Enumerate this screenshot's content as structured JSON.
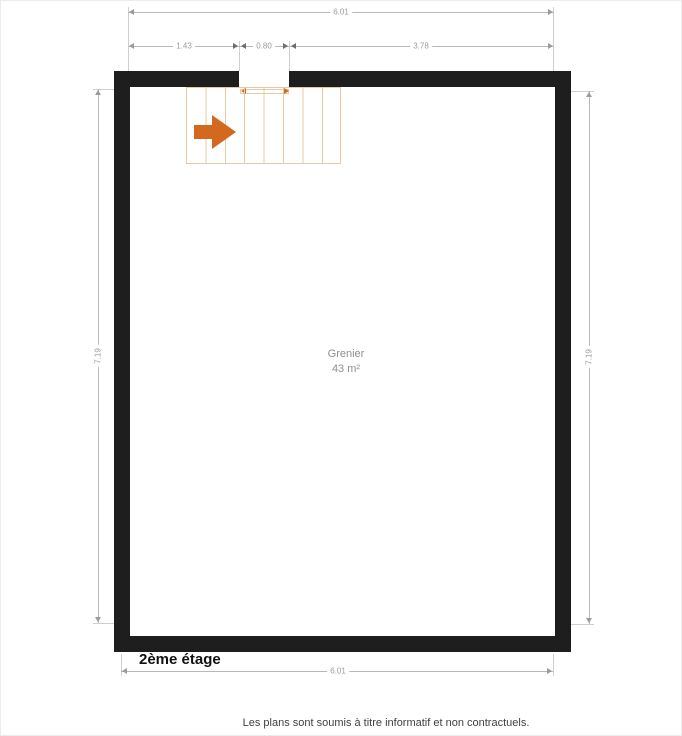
{
  "plan": {
    "floor_label": "2ème étage",
    "room": {
      "name": "Grenier",
      "area": "43 m²"
    },
    "dimensions": {
      "top_total": "6.01",
      "top_segments": [
        "1.43",
        "0.80",
        "3.78"
      ],
      "left_height": "7.19",
      "right_height": "7.19",
      "bottom_total": "6.01"
    },
    "stairs": {
      "treads": 8,
      "direction": "right"
    }
  },
  "footer": {
    "disclaimer": "Les plans sont soumis à titre informatif et non contractuels."
  },
  "colors": {
    "wall": "#1e1e1e",
    "stair_outline": "#e9c9a3",
    "stair_arrow": "#d2691e",
    "dimension_line": "#b8b8b8",
    "dimension_text": "#9b9b9b",
    "room_text": "#8f8f8f",
    "floor_label_text": "#111111",
    "footer_text": "#3f3f3f"
  }
}
